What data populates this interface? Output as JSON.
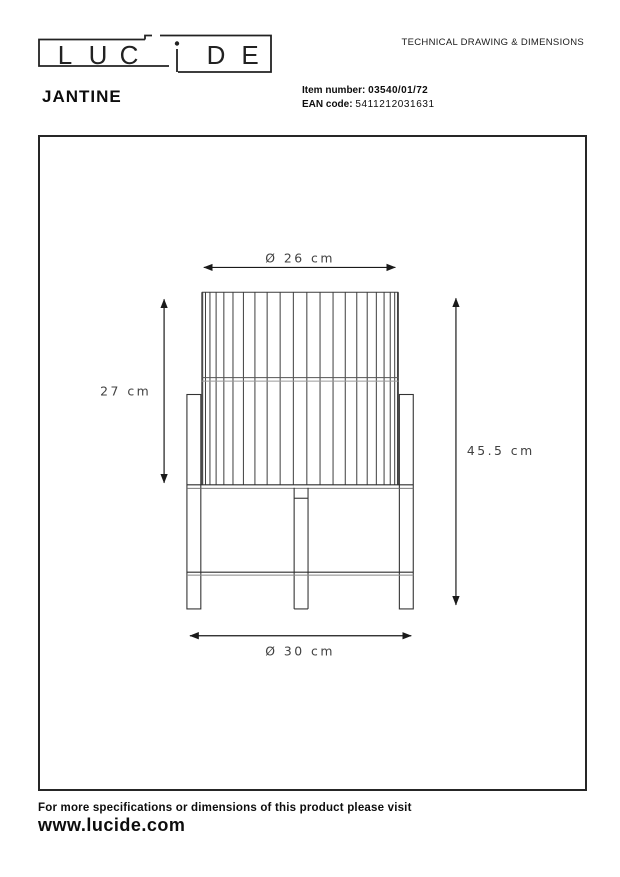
{
  "header": {
    "doc_title": "TECHNICAL DRAWING & DIMENSIONS",
    "logo_letters": [
      "L",
      "U",
      "C",
      "D",
      "E"
    ],
    "product_name": "JANTINE",
    "item_number_label": "Item number:",
    "item_number_value": "03540/01/72",
    "ean_label": "EAN code:",
    "ean_value": "5411212031631"
  },
  "drawing": {
    "dimensions": {
      "top_diameter": "Ø 26 cm",
      "shade_height": "27 cm",
      "total_height": "45.5 cm",
      "base_diameter": "Ø 30 cm"
    }
  },
  "footer": {
    "note": "For more specifications or dimensions of this product please visit",
    "website": "www.lucide.com"
  }
}
